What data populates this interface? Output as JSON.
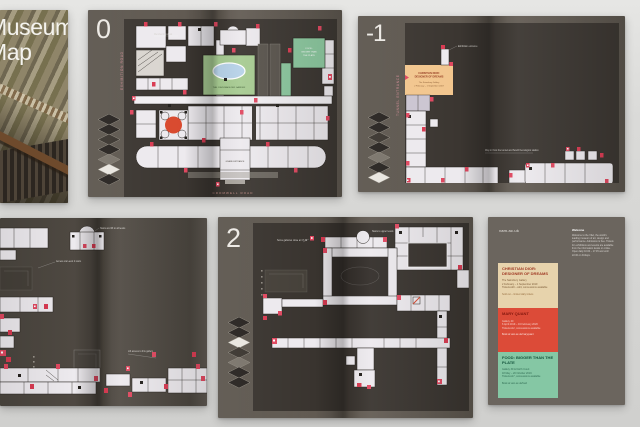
{
  "colors": {
    "backdrop": "#d9d9d7",
    "page_dark": "#57514a",
    "map_panel": "#3b3631",
    "plan_room": "#edeaee",
    "accent_pink": "#e04860",
    "rotunda_red": "#d94a2f",
    "garden_green": "#a7cb92",
    "pond_blue": "#b7d2e8",
    "gallery_mint": "#8cc89f",
    "dior_orange": "#f2c68e",
    "block_tan": "#e7d3ac",
    "block_red": "#dc4b38",
    "block_green": "#85c7a4"
  },
  "cover": {
    "title_line1": "Museum",
    "title_line2": "Map"
  },
  "level0": {
    "level": "0",
    "street_left": "EXHIBITION ROAD",
    "street_bottom": "CROMWELL ROAD",
    "garden": "THE JOHN MADEJSKI GARDEN",
    "grand_entrance": "GRAND ENTRANCE",
    "mint1": "FOOD:",
    "mint2": "BIGGER THAN",
    "mint3": "THE PLATE",
    "note_top": "Membership desk"
  },
  "level_minus1": {
    "level": "-1",
    "street_left": "TUNNEL ENTRANCE",
    "dior_title1": "CHRISTIAN DIOR:",
    "dior_title2": "DESIGNER OF DREAMS",
    "dior_sub": "The Sainsbury Gallery",
    "dior_dates": "2 February – 1 September 2019",
    "note_top": "Exhibition entrance",
    "note_mid": "Way in from the tunnel and South Kensington station"
  },
  "level1_partial": {
    "note_dome": "Stairs and lift to all levels",
    "note_left": "Access via Level 2 stairs",
    "note_mid": "Lift access to this gallery"
  },
  "level2": {
    "level": "2",
    "note_top": "Some galleries close at 17.30",
    "note_dome": "Stairs to upper levels"
  },
  "back_cover": {
    "website": "vam.ac.uk",
    "info_heading": "Welcome",
    "info_body": "Welcome to the V&A, the world's leading museum of art, design and performance. Admission is free. Tickets for exhibitions and events are available from the information desks or online. Open daily 10.00 – 17.45 and until 22.00 on Fridays.",
    "exhibitions": [
      {
        "title": "CHRISTIAN DIOR: DESIGNER OF DREAMS",
        "line1": "The Sainsbury Gallery",
        "line2": "2 February – 1 September 2019",
        "line3": "Tickets £20 – £24, concessions available",
        "footer": "Sold out – limited daily tickets"
      },
      {
        "title": "MARY QUANT",
        "line1": "Gallery 40",
        "line2": "6 April 2019 – 16 February 2020",
        "line3": "Tickets £12, concessions available",
        "footer": "Book at vam.ac.uk/maryquant"
      },
      {
        "title": "FOOD: BIGGER THAN THE PLATE",
        "line1": "Gallery 39 & North Court",
        "line2": "18 May – 20 October 2019",
        "line3": "Tickets £17, concessions available",
        "footer": "Book at vam.ac.uk/food"
      }
    ]
  }
}
